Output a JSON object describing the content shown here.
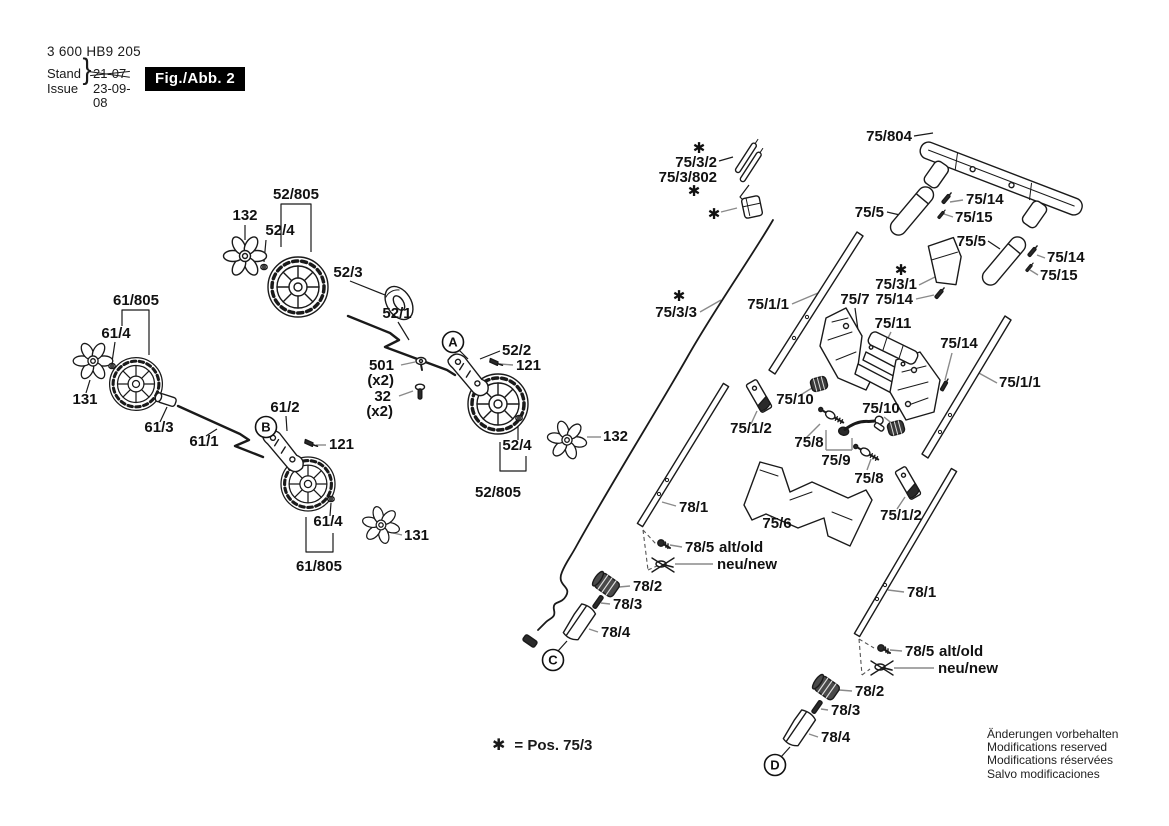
{
  "header": {
    "part_number": "3 600 HB9 205",
    "stand_label": "Stand",
    "issue_label": "Issue",
    "brace": "}",
    "old_date": "21-07",
    "date": "23-09-08",
    "figure_label": "Fig./Abb. 2"
  },
  "footnote": {
    "symbol": "✱",
    "text": "= Pos. 75/3"
  },
  "disclaimer": {
    "lines": [
      "Änderungen vorbehalten",
      "Modifications reserved",
      "Modifications réservées",
      "Salvo modificaciones"
    ]
  },
  "view_markers": [
    {
      "letter": "A",
      "x": 453,
      "y": 342
    },
    {
      "letter": "B",
      "x": 266,
      "y": 427
    },
    {
      "letter": "C",
      "x": 553,
      "y": 660
    },
    {
      "letter": "D",
      "x": 775,
      "y": 765
    }
  ],
  "part_labels": [
    {
      "text": "52/805",
      "x": 296,
      "y": 199,
      "anchor": "middle"
    },
    {
      "text": "132",
      "x": 245,
      "y": 220,
      "anchor": "middle"
    },
    {
      "text": "52/4",
      "x": 280,
      "y": 235,
      "anchor": "middle"
    },
    {
      "text": "52/3",
      "x": 348,
      "y": 277,
      "anchor": "middle"
    },
    {
      "text": "52/1",
      "x": 397,
      "y": 318,
      "anchor": "middle"
    },
    {
      "text": "52/2",
      "x": 502,
      "y": 355,
      "anchor": "start"
    },
    {
      "text": "121",
      "x": 516,
      "y": 370,
      "anchor": "start"
    },
    {
      "text": "501",
      "x": 394,
      "y": 370,
      "anchor": "end"
    },
    {
      "text": "(x2)",
      "x": 394,
      "y": 385,
      "anchor": "end",
      "size": 13
    },
    {
      "text": "32",
      "x": 391,
      "y": 401,
      "anchor": "end"
    },
    {
      "text": "(x2)",
      "x": 393,
      "y": 416,
      "anchor": "end",
      "size": 13
    },
    {
      "text": "61/805",
      "x": 136,
      "y": 305,
      "anchor": "middle"
    },
    {
      "text": "61/4",
      "x": 116,
      "y": 338,
      "anchor": "middle"
    },
    {
      "text": "131",
      "x": 85,
      "y": 404,
      "anchor": "middle"
    },
    {
      "text": "61/3",
      "x": 159,
      "y": 432,
      "anchor": "middle"
    },
    {
      "text": "61/1",
      "x": 204,
      "y": 446,
      "anchor": "middle"
    },
    {
      "text": "61/2",
      "x": 285,
      "y": 412,
      "anchor": "middle"
    },
    {
      "text": "121",
      "x": 329,
      "y": 449,
      "anchor": "start"
    },
    {
      "text": "61/4",
      "x": 328,
      "y": 526,
      "anchor": "middle"
    },
    {
      "text": "131",
      "x": 404,
      "y": 540,
      "anchor": "start"
    },
    {
      "text": "61/805",
      "x": 319,
      "y": 571,
      "anchor": "middle"
    },
    {
      "text": "52/4",
      "x": 517,
      "y": 450,
      "anchor": "middle"
    },
    {
      "text": "132",
      "x": 603,
      "y": 441,
      "anchor": "start"
    },
    {
      "text": "52/805",
      "x": 498,
      "y": 497,
      "anchor": "middle"
    },
    {
      "text": "✱",
      "x": 699,
      "y": 153,
      "anchor": "middle",
      "size": 17
    },
    {
      "text": "75/3/2",
      "x": 717,
      "y": 167,
      "anchor": "end"
    },
    {
      "text": "75/3/802",
      "x": 717,
      "y": 182,
      "anchor": "end"
    },
    {
      "text": "✱",
      "x": 694,
      "y": 196,
      "anchor": "middle",
      "size": 17
    },
    {
      "text": "✱",
      "x": 714,
      "y": 219,
      "anchor": "middle",
      "size": 17
    },
    {
      "text": "75/804",
      "x": 912,
      "y": 141,
      "anchor": "end"
    },
    {
      "text": "75/5",
      "x": 884,
      "y": 217,
      "anchor": "end"
    },
    {
      "text": "75/14",
      "x": 966,
      "y": 204,
      "anchor": "start"
    },
    {
      "text": "75/15",
      "x": 955,
      "y": 222,
      "anchor": "start"
    },
    {
      "text": "75/5",
      "x": 986,
      "y": 246,
      "anchor": "end"
    },
    {
      "text": "75/14",
      "x": 1047,
      "y": 262,
      "anchor": "start"
    },
    {
      "text": "75/15",
      "x": 1040,
      "y": 280,
      "anchor": "start"
    },
    {
      "text": "✱",
      "x": 901,
      "y": 275,
      "anchor": "middle",
      "size": 17
    },
    {
      "text": "75/3/1",
      "x": 917,
      "y": 289,
      "anchor": "end"
    },
    {
      "text": "75/14",
      "x": 913,
      "y": 304,
      "anchor": "end"
    },
    {
      "text": "75/7",
      "x": 855,
      "y": 304,
      "anchor": "middle"
    },
    {
      "text": "75/1/1",
      "x": 789,
      "y": 309,
      "anchor": "end"
    },
    {
      "text": "✱",
      "x": 679,
      "y": 301,
      "anchor": "middle",
      "size": 17
    },
    {
      "text": "75/3/3",
      "x": 697,
      "y": 317,
      "anchor": "end"
    },
    {
      "text": "75/11",
      "x": 893,
      "y": 328,
      "anchor": "middle"
    },
    {
      "text": "75/14",
      "x": 959,
      "y": 348,
      "anchor": "middle"
    },
    {
      "text": "75/1/1",
      "x": 999,
      "y": 387,
      "anchor": "start"
    },
    {
      "text": "75/10",
      "x": 795,
      "y": 404,
      "anchor": "middle"
    },
    {
      "text": "75/10",
      "x": 881,
      "y": 413,
      "anchor": "middle"
    },
    {
      "text": "75/1/2",
      "x": 751,
      "y": 433,
      "anchor": "middle"
    },
    {
      "text": "75/8",
      "x": 809,
      "y": 447,
      "anchor": "middle"
    },
    {
      "text": "75/9",
      "x": 836,
      "y": 465,
      "anchor": "middle"
    },
    {
      "text": "75/8",
      "x": 869,
      "y": 483,
      "anchor": "middle"
    },
    {
      "text": "75/6",
      "x": 777,
      "y": 528,
      "anchor": "middle"
    },
    {
      "text": "75/1/2",
      "x": 901,
      "y": 520,
      "anchor": "middle"
    },
    {
      "text": "78/1",
      "x": 679,
      "y": 512,
      "anchor": "start"
    },
    {
      "text": "78/5",
      "x": 685,
      "y": 552,
      "anchor": "start"
    },
    {
      "text": "alt/old",
      "x": 719,
      "y": 552,
      "anchor": "start"
    },
    {
      "text": "neu/new",
      "x": 717,
      "y": 569,
      "anchor": "start"
    },
    {
      "text": "78/2",
      "x": 633,
      "y": 591,
      "anchor": "start"
    },
    {
      "text": "78/3",
      "x": 613,
      "y": 609,
      "anchor": "start"
    },
    {
      "text": "78/4",
      "x": 601,
      "y": 637,
      "anchor": "start"
    },
    {
      "text": "78/1",
      "x": 907,
      "y": 597,
      "anchor": "start"
    },
    {
      "text": "78/5",
      "x": 905,
      "y": 656,
      "anchor": "start"
    },
    {
      "text": "alt/old",
      "x": 939,
      "y": 656,
      "anchor": "start"
    },
    {
      "text": "neu/new",
      "x": 938,
      "y": 673,
      "anchor": "start"
    },
    {
      "text": "78/2",
      "x": 855,
      "y": 696,
      "anchor": "start"
    },
    {
      "text": "78/3",
      "x": 831,
      "y": 715,
      "anchor": "start"
    },
    {
      "text": "78/4",
      "x": 821,
      "y": 742,
      "anchor": "start"
    }
  ]
}
